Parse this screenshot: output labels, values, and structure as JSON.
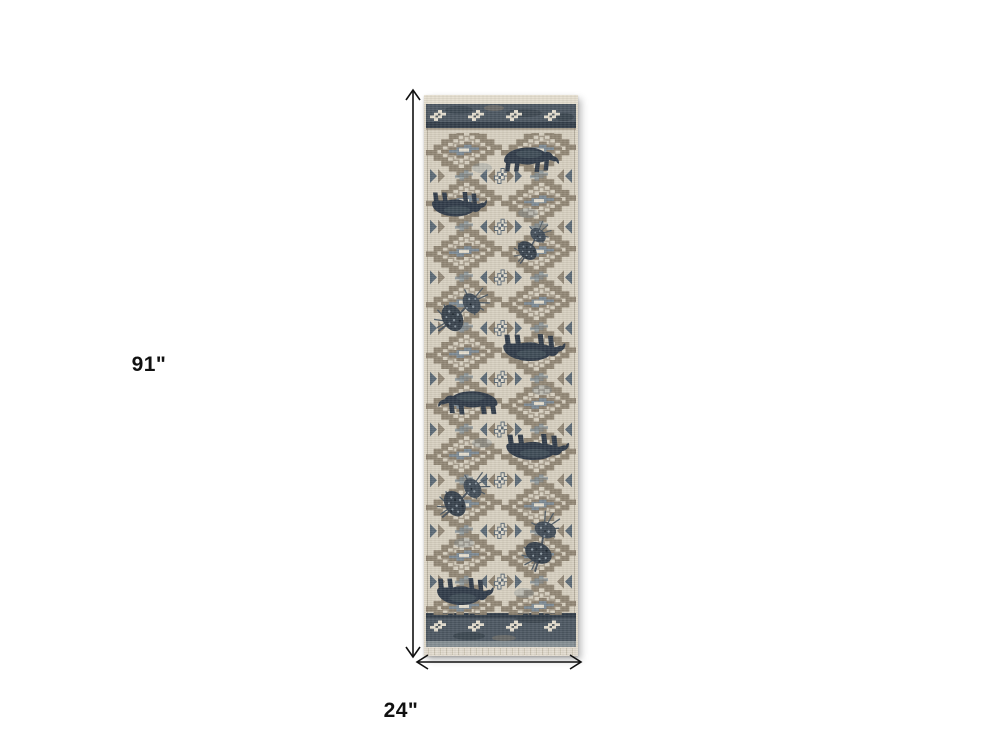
{
  "page": {
    "background": "#ffffff"
  },
  "dimension_labels": {
    "height": "91\"",
    "width": "24\""
  },
  "icons": {
    "vertical_arrow": "double-headed-arrow-vertical",
    "horizontal_arrow": "double-headed-arrow-horizontal"
  },
  "colors": {
    "page_bg": "#ffffff",
    "arrow": "#111111",
    "label_text": "#111111",
    "cream": "#d8d1c1",
    "cream_light": "#e6dfd0",
    "selvedge": "#ded7c7",
    "taupe": "#8d8170",
    "slate": "#7d8b96",
    "slate_dark": "#5c6a76",
    "band": "#4d5862",
    "navy": "#333e49",
    "bear": "#313c49",
    "bear_light": "#56646f",
    "pine_dark": "#38424d",
    "pine_mid": "#424d58",
    "branch": "#4a545e",
    "speckle": "#95a1aa",
    "fringe": "#e3dcd0",
    "fringe_tick": "#c8c0af"
  }
}
